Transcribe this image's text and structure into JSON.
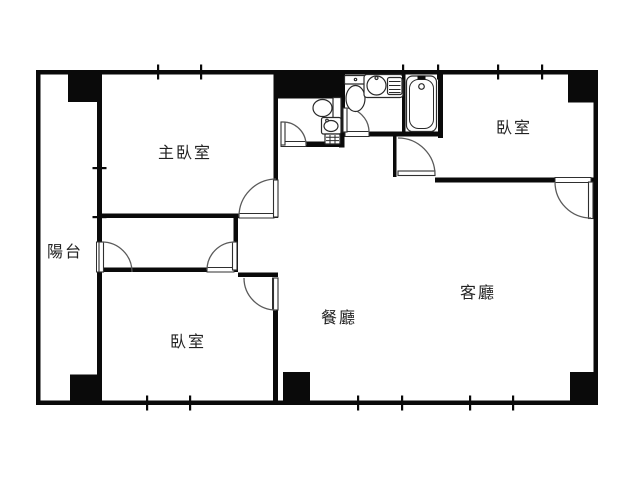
{
  "floorplan": {
    "title": "apartment-floor-plan",
    "colors": {
      "wall": "#0a0a0a",
      "line": "#5a5a5a",
      "text": "#222222",
      "background": "#ffffff"
    },
    "rooms": [
      {
        "id": "balcony",
        "label": "陽台",
        "cx": 65,
        "cy": 250
      },
      {
        "id": "master-bedroom",
        "label": "主臥室",
        "cx": 185,
        "cy": 151
      },
      {
        "id": "bedroom-lower-left",
        "label": "臥室",
        "cx": 188,
        "cy": 340
      },
      {
        "id": "bedroom-upper-right",
        "label": "臥室",
        "cx": 514,
        "cy": 126
      },
      {
        "id": "dining-room",
        "label": "餐廳",
        "cx": 339,
        "cy": 316
      },
      {
        "id": "living-room",
        "label": "客廳",
        "cx": 478,
        "cy": 291
      }
    ],
    "fixtures": [
      {
        "name": "toilet-small-bath"
      },
      {
        "name": "vanity-small-bath"
      },
      {
        "name": "toilet-main-bath"
      },
      {
        "name": "counter-sink"
      },
      {
        "name": "stove-rack"
      },
      {
        "name": "bathtub"
      }
    ],
    "doors": [
      "master-bedroom-door",
      "balcony-door",
      "corridor-bedroom-door",
      "bedroom-dining-door",
      "small-bath-door",
      "main-bath-door",
      "entry-nook-door",
      "bedroom-upper-right-door"
    ],
    "window_marks": {
      "top_wall_x": [
        158,
        201,
        403,
        438,
        498,
        542
      ],
      "bottom_wall_x": [
        147,
        190,
        358,
        402,
        470,
        513
      ],
      "left_divider_y": [
        168,
        217
      ]
    }
  }
}
